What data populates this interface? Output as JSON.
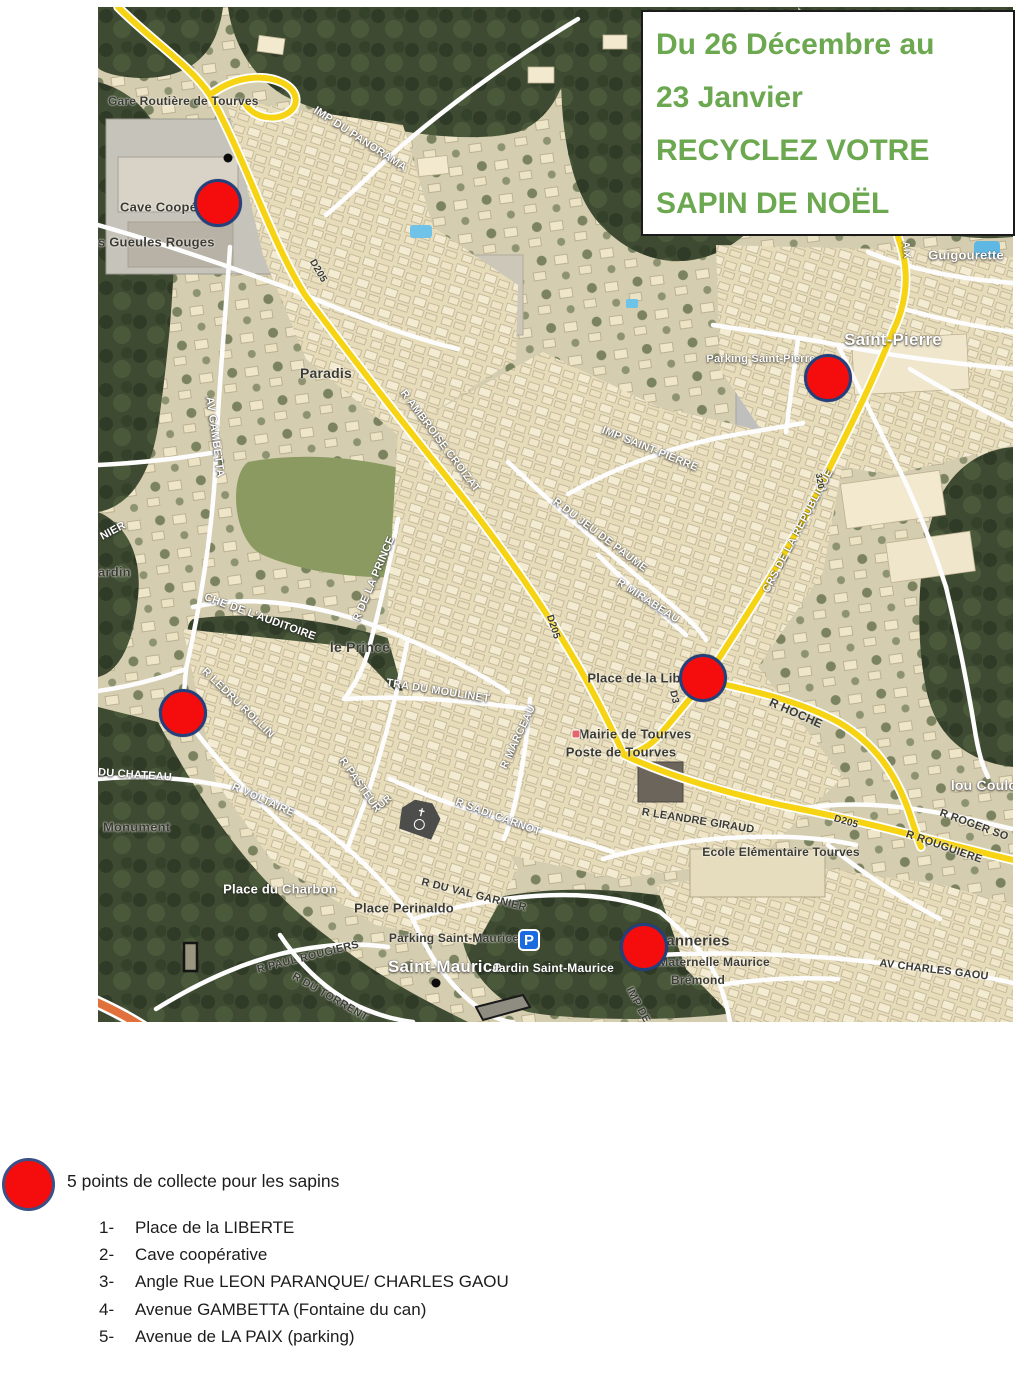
{
  "title": {
    "lines": [
      "Du 26 Décembre au",
      "23 Janvier",
      "RECYCLEZ VOTRE",
      "SAPIN DE NOËL"
    ],
    "text_color": "#6BA84F"
  },
  "legend": {
    "title": "5 points de collecte pour les sapins",
    "items": [
      {
        "num": "1-",
        "text": "Place de la LIBERTE"
      },
      {
        "num": "2-",
        "text": "Cave coopérative"
      },
      {
        "num": "3-",
        "text": "Angle Rue LEON PARANQUE/ CHARLES GAOU"
      },
      {
        "num": "4-",
        "text": "Avenue GAMBETTA (Fontaine du can)"
      },
      {
        "num": "5-",
        "text": "Avenue de LA PAIX (parking)"
      }
    ]
  },
  "colors": {
    "marker_red": "#f50d0d",
    "marker_border": "#24407c",
    "road_yellow": "#f6d414",
    "title_green": "#6BA84F"
  },
  "map": {
    "markers": [
      {
        "x": 120,
        "y": 196,
        "near": "Cave coopérative"
      },
      {
        "x": 730,
        "y": 371,
        "near": "Parking Saint-Pierre"
      },
      {
        "x": 605,
        "y": 671,
        "near": "Place de la Liberté"
      },
      {
        "x": 85,
        "y": 706,
        "near": "R Ledru Rollin / Av Gambetta"
      },
      {
        "x": 546,
        "y": 940,
        "near": "Tanneries"
      }
    ],
    "pois": [
      {
        "type": "parking-icon",
        "x": 431,
        "y": 933
      },
      {
        "type": "church-icon",
        "x": 322,
        "y": 812
      },
      {
        "type": "townhall-icon",
        "x": 478,
        "y": 727
      },
      {
        "type": "spot-dot",
        "x": 130,
        "y": 151
      },
      {
        "type": "spot-dot",
        "x": 338,
        "y": 976
      }
    ],
    "labels": [
      {
        "t": "Gare Routière de Tourves",
        "x": 10,
        "y": 94,
        "c": "d",
        "s": 12,
        "a": "l"
      },
      {
        "t": "Cave Coopé",
        "x": 22,
        "y": 200,
        "c": "d",
        "s": 13,
        "a": "l"
      },
      {
        "t": "s Gueules Rouges",
        "x": 0,
        "y": 235,
        "c": "d",
        "s": 13,
        "a": "l"
      },
      {
        "t": "IMP DU PANORAMA",
        "x": 262,
        "y": 132,
        "r": 33,
        "c": "w",
        "s": 11
      },
      {
        "t": "D205",
        "x": 220,
        "y": 264,
        "r": 60,
        "c": "d",
        "s": 10
      },
      {
        "t": "Paradis",
        "x": 228,
        "y": 366,
        "c": "d",
        "s": 14
      },
      {
        "t": "R AMBROISE CROIZAT",
        "x": 342,
        "y": 434,
        "r": 53,
        "c": "w",
        "s": 11
      },
      {
        "t": "AV GAMBETTA",
        "x": 117,
        "y": 430,
        "r": 82,
        "c": "w",
        "s": 11
      },
      {
        "t": "Guigourette",
        "x": 868,
        "y": 248,
        "c": "w",
        "s": 13
      },
      {
        "t": "Saint-Pierre",
        "x": 795,
        "y": 333,
        "c": "w",
        "s": 17
      },
      {
        "t": "Parking Saint-Pierre",
        "x": 663,
        "y": 352,
        "c": "w",
        "s": 11
      },
      {
        "t": "IMP SAINT-PIERRE",
        "x": 552,
        "y": 442,
        "r": 22,
        "c": "w",
        "s": 11
      },
      {
        "t": "R DU JEU DE PAUME",
        "x": 502,
        "y": 528,
        "r": 37,
        "c": "w",
        "s": 11
      },
      {
        "t": "R MIRABEAU",
        "x": 550,
        "y": 594,
        "r": 33,
        "c": "w",
        "s": 11
      },
      {
        "t": "CRS DE LA REPUBLIQUE",
        "x": 700,
        "y": 524,
        "r": -62,
        "c": "w",
        "s": 11
      },
      {
        "t": "320",
        "x": 722,
        "y": 474,
        "r": 80,
        "c": "d",
        "s": 9
      },
      {
        "t": "D205",
        "x": 455,
        "y": 620,
        "r": 72,
        "c": "d",
        "s": 10
      },
      {
        "t": "NIER",
        "x": 15,
        "y": 524,
        "r": -28,
        "c": "w",
        "s": 11
      },
      {
        "t": "ardin",
        "x": 0,
        "y": 565,
        "c": "d",
        "s": 13,
        "a": "l"
      },
      {
        "t": "CHE DE L'AUDITOIRE",
        "x": 162,
        "y": 610,
        "r": 20,
        "c": "w",
        "s": 11
      },
      {
        "t": "R DE LA PRINCE",
        "x": 276,
        "y": 572,
        "r": -67,
        "c": "w",
        "s": 11
      },
      {
        "t": "le Prince",
        "x": 262,
        "y": 640,
        "c": "d",
        "s": 14
      },
      {
        "t": "TRA DU MOULINET",
        "x": 340,
        "y": 684,
        "r": 9,
        "c": "w",
        "s": 11
      },
      {
        "t": "R LEDRU ROLLIN",
        "x": 140,
        "y": 696,
        "r": 44,
        "c": "w",
        "s": 11
      },
      {
        "t": "DU CHATEAU",
        "x": 0,
        "y": 768,
        "r": 4,
        "c": "w",
        "s": 11,
        "a": "l"
      },
      {
        "t": "Monument",
        "x": 5,
        "y": 820,
        "c": "d",
        "s": 13,
        "a": "l"
      },
      {
        "t": "R VOLTAIRE",
        "x": 165,
        "y": 793,
        "r": 24,
        "c": "w",
        "s": 11
      },
      {
        "t": "R PASTEUR",
        "x": 262,
        "y": 778,
        "r": 55,
        "c": "w",
        "s": 11
      },
      {
        "t": "Place du Charbon",
        "x": 182,
        "y": 882,
        "c": "w",
        "s": 13
      },
      {
        "t": "Place Perinaldo",
        "x": 306,
        "y": 901,
        "c": "d",
        "s": 13
      },
      {
        "t": "R DU VAL GARNIER",
        "x": 376,
        "y": 888,
        "r": 14,
        "c": "d",
        "s": 11
      },
      {
        "t": "Parking Saint-Maurice",
        "x": 356,
        "y": 931,
        "c": "d",
        "s": 12
      },
      {
        "t": "Saint-Maurice",
        "x": 347,
        "y": 960,
        "c": "w",
        "s": 17
      },
      {
        "t": "Jardin Saint-Maurice",
        "x": 455,
        "y": 961,
        "c": "w",
        "s": 12
      },
      {
        "t": "R PAUL ROUGIERS",
        "x": 210,
        "y": 950,
        "r": -14,
        "c": "d",
        "s": 11
      },
      {
        "t": "R DU TORRENT",
        "x": 232,
        "y": 990,
        "r": 30,
        "c": "d",
        "s": 11
      },
      {
        "t": "anneries",
        "x": 600,
        "y": 934,
        "c": "d",
        "s": 15
      },
      {
        "t": "Maternelle Maurice",
        "x": 616,
        "y": 955,
        "c": "d",
        "s": 12
      },
      {
        "t": "Brémond",
        "x": 600,
        "y": 973,
        "c": "d",
        "s": 12
      },
      {
        "t": "AV CHARLES GAOU",
        "x": 836,
        "y": 963,
        "r": 7,
        "c": "d",
        "s": 11
      },
      {
        "t": "IMP DE",
        "x": 540,
        "y": 998,
        "r": 62,
        "c": "d",
        "s": 11
      },
      {
        "t": "R LEANDRE GIRAUD",
        "x": 600,
        "y": 814,
        "r": 9,
        "c": "d",
        "s": 11
      },
      {
        "t": "Ecole Elémentaire Tourves",
        "x": 683,
        "y": 845,
        "c": "d",
        "s": 12
      },
      {
        "t": "lou Coulo",
        "x": 886,
        "y": 778,
        "c": "w",
        "s": 14
      },
      {
        "t": "R ROGER SO",
        "x": 876,
        "y": 818,
        "r": 20,
        "c": "d",
        "s": 11
      },
      {
        "t": "D205",
        "x": 748,
        "y": 815,
        "r": 16,
        "c": "d",
        "s": 10
      },
      {
        "t": "R ROUGUIERE",
        "x": 846,
        "y": 840,
        "r": 19,
        "c": "d",
        "s": 11
      },
      {
        "t": "Mairie de Tourves",
        "x": 537,
        "y": 727,
        "c": "d",
        "s": 13
      },
      {
        "t": "Poste de Tourves",
        "x": 523,
        "y": 745,
        "c": "d",
        "s": 13
      },
      {
        "t": "Place de la Lib",
        "x": 536,
        "y": 671,
        "c": "d",
        "s": 13
      },
      {
        "t": "D3",
        "x": 576,
        "y": 690,
        "r": 78,
        "c": "d",
        "s": 10
      },
      {
        "t": "R HOCHE",
        "x": 698,
        "y": 706,
        "r": 24,
        "c": "d",
        "s": 12
      },
      {
        "t": "R MARCEAU",
        "x": 420,
        "y": 730,
        "r": -65,
        "c": "w",
        "s": 11
      },
      {
        "t": "R SADI CARNOT",
        "x": 400,
        "y": 810,
        "r": 20,
        "c": "w",
        "s": 11
      },
      {
        "t": "UR",
        "x": 287,
        "y": 795,
        "r": -40,
        "c": "w",
        "s": 10
      },
      {
        "t": "AIX",
        "x": 808,
        "y": 243,
        "r": 85,
        "c": "w",
        "s": 10
      }
    ]
  }
}
